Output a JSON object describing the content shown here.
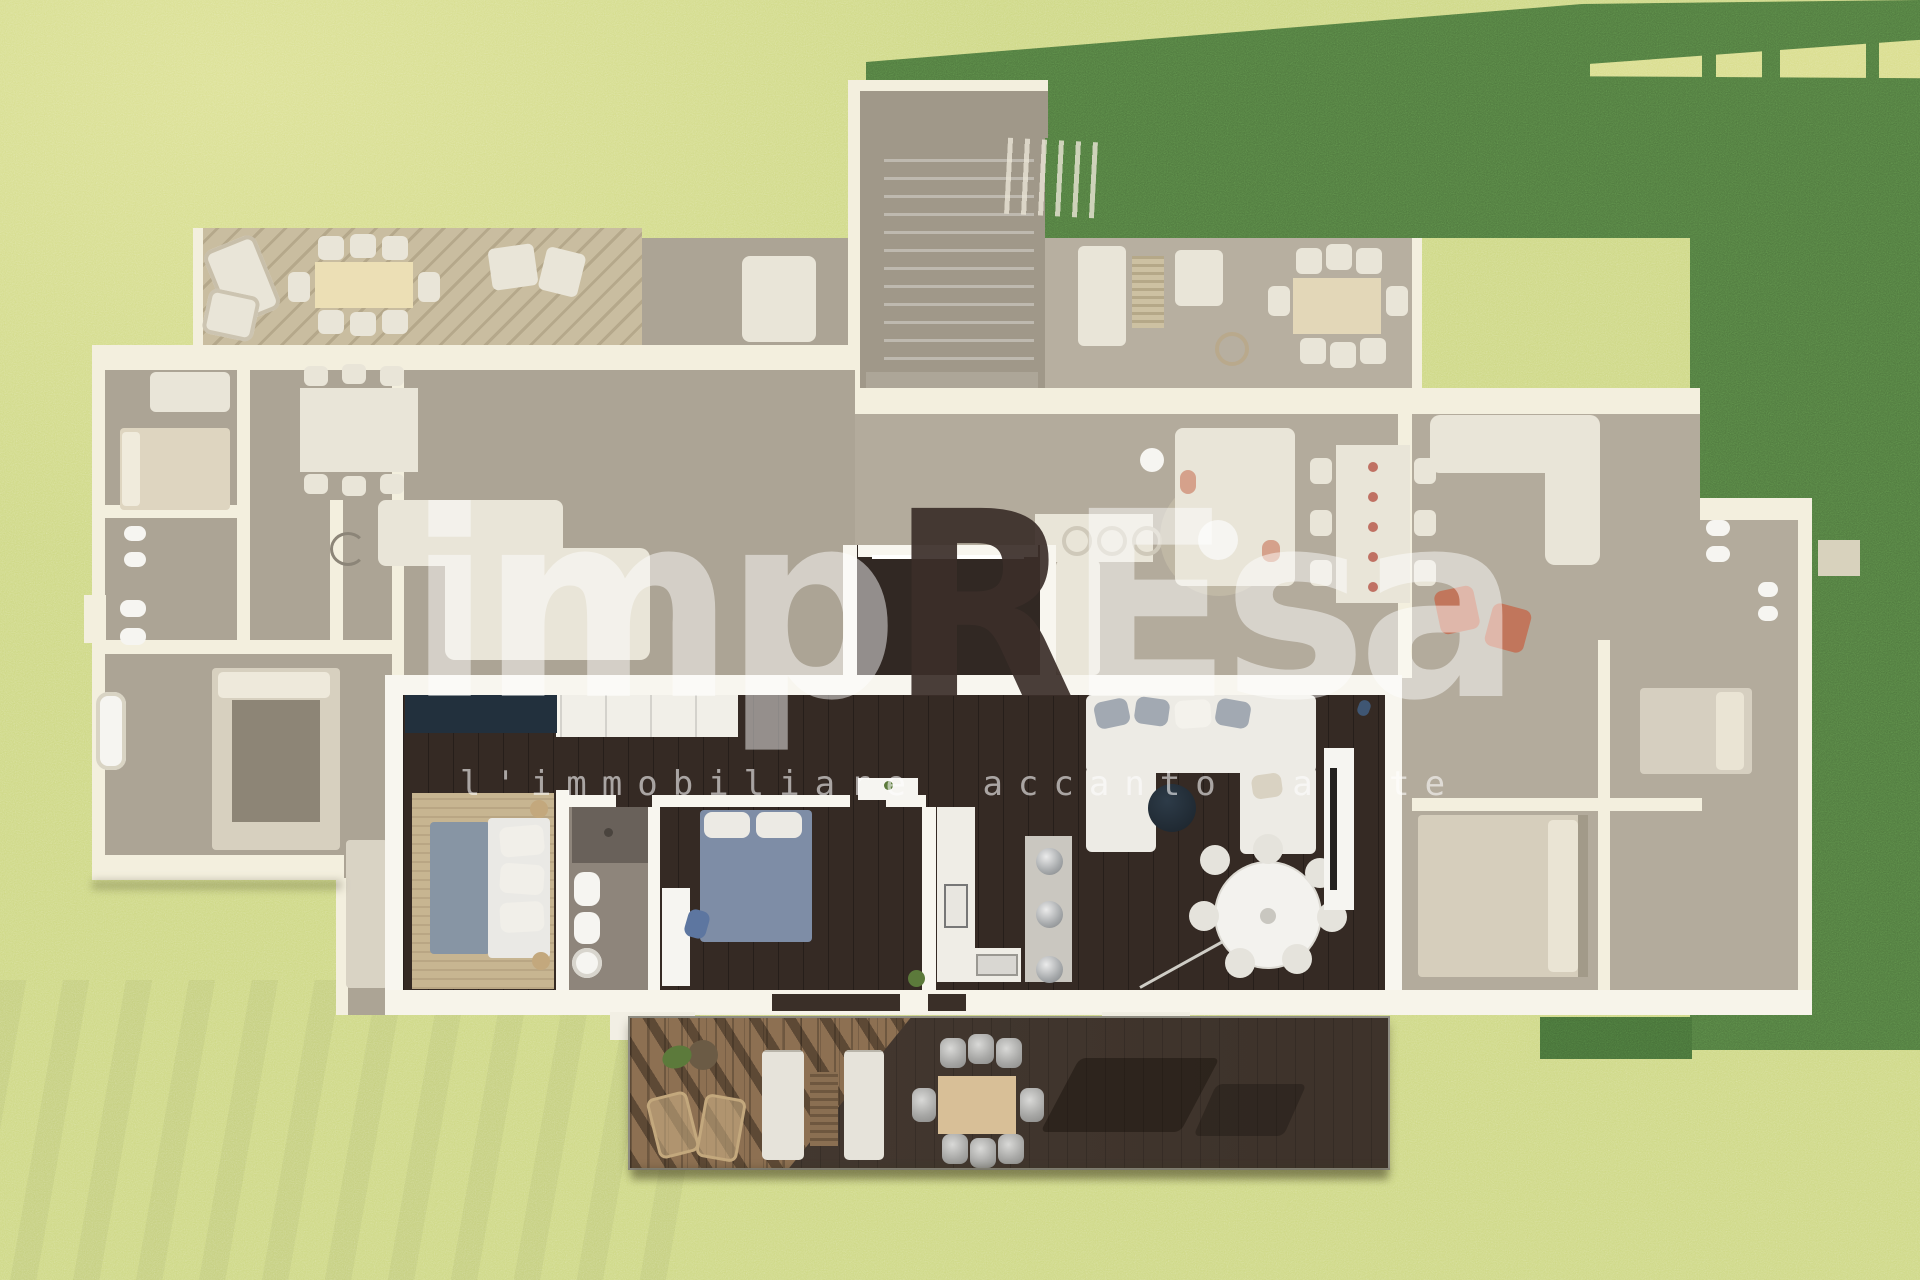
{
  "watermark": {
    "brand_prefix": "imp",
    "brand_r": "R",
    "brand_e": "E",
    "brand_suffix": "sa",
    "tagline": "l'immobiliare accanto a te"
  },
  "palette": {
    "grass_light": "#ced884",
    "grass_bright": "#dce194",
    "green_dark": "#50793f",
    "green_dark2": "#466f38",
    "slit": "#d9dd8b",
    "ghost_wall": "#f3efde",
    "ghost_floor": "#aca495",
    "ghost_floor2": "#b3ab9c",
    "ghost_deck_left": "#c9bda0",
    "ghost_deck_right": "#b7afa0",
    "ghost_white": "#e9e5d8",
    "ghost_stair": "#a09889",
    "unit_wall": "#f8f6ef",
    "unit_floor": "#352a24",
    "corridor_floor": "#312823",
    "navy": "#22303d",
    "navy_pouf": "#2d3b48",
    "rug": "#c7b591",
    "blue_throw": "#8795a4",
    "duvet": "#eae9e5",
    "bed2_blue": "#7e8da6",
    "bath_floor": "#8e857b",
    "shower": "#69615a",
    "fixture": "#f6f5f1",
    "counter": "#efede6",
    "peninsula": "#cac7c0",
    "steel": "#b9babb",
    "sofa_white": "#edebe5",
    "pillow_gray": "#a2a9b2",
    "pillow_warm": "#d9d2c2",
    "table_white": "#f3f2ee",
    "lamp_gray": "#cfcdc6",
    "tv_black": "#23211f",
    "deck_dark": "#443931",
    "deck_light": "#8d7052",
    "out_sofa": "#e6e3da",
    "out_table": "#d8bf97",
    "out_metal": "#a7a7a5",
    "wicker": "#c3a87d",
    "plant_green": "#5c7a3b",
    "coral": "#c4694c",
    "red_dot": "#b14a3c",
    "wm_white": "#ffffff",
    "wm_dark": "#3b2e2a"
  }
}
